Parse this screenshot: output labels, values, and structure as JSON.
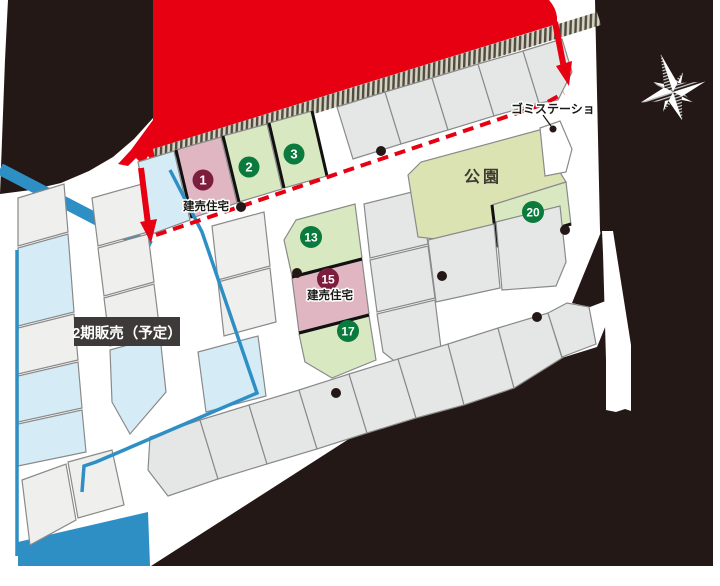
{
  "map": {
    "phase2_badge_label": "2期販売（予定）",
    "park_label": "公園",
    "garbage_station_label": "ゴミステーショ",
    "lots": [
      {
        "id": "lot-1",
        "number": "1",
        "type": "built-for-sale",
        "label": "建売住宅"
      },
      {
        "id": "lot-2",
        "number": "2",
        "type": "for-sale"
      },
      {
        "id": "lot-3",
        "number": "3",
        "type": "for-sale"
      },
      {
        "id": "lot-13",
        "number": "13",
        "type": "for-sale"
      },
      {
        "id": "lot-15",
        "number": "15",
        "type": "built-for-sale",
        "label": "建売住宅"
      },
      {
        "id": "lot-17",
        "number": "17",
        "type": "for-sale"
      },
      {
        "id": "lot-20",
        "number": "20",
        "type": "for-sale"
      }
    ],
    "colors": {
      "background_black": "#231815",
      "road_red": "#e60012",
      "boundary_blue": "#2e8fc5",
      "lot_gray": "#e5e7e6",
      "lot_gray_phase2": "#efefee",
      "lot_light_blue": "#d5ecf7",
      "lot_light_green": "#d8e8c0",
      "park_olive": "#dce3b2",
      "lot_pink": "#e0b6c3",
      "badge_green": "#0a7a3d",
      "badge_maroon": "#7d1d3e",
      "phase2_badge_bg": "#3e3a39"
    }
  }
}
